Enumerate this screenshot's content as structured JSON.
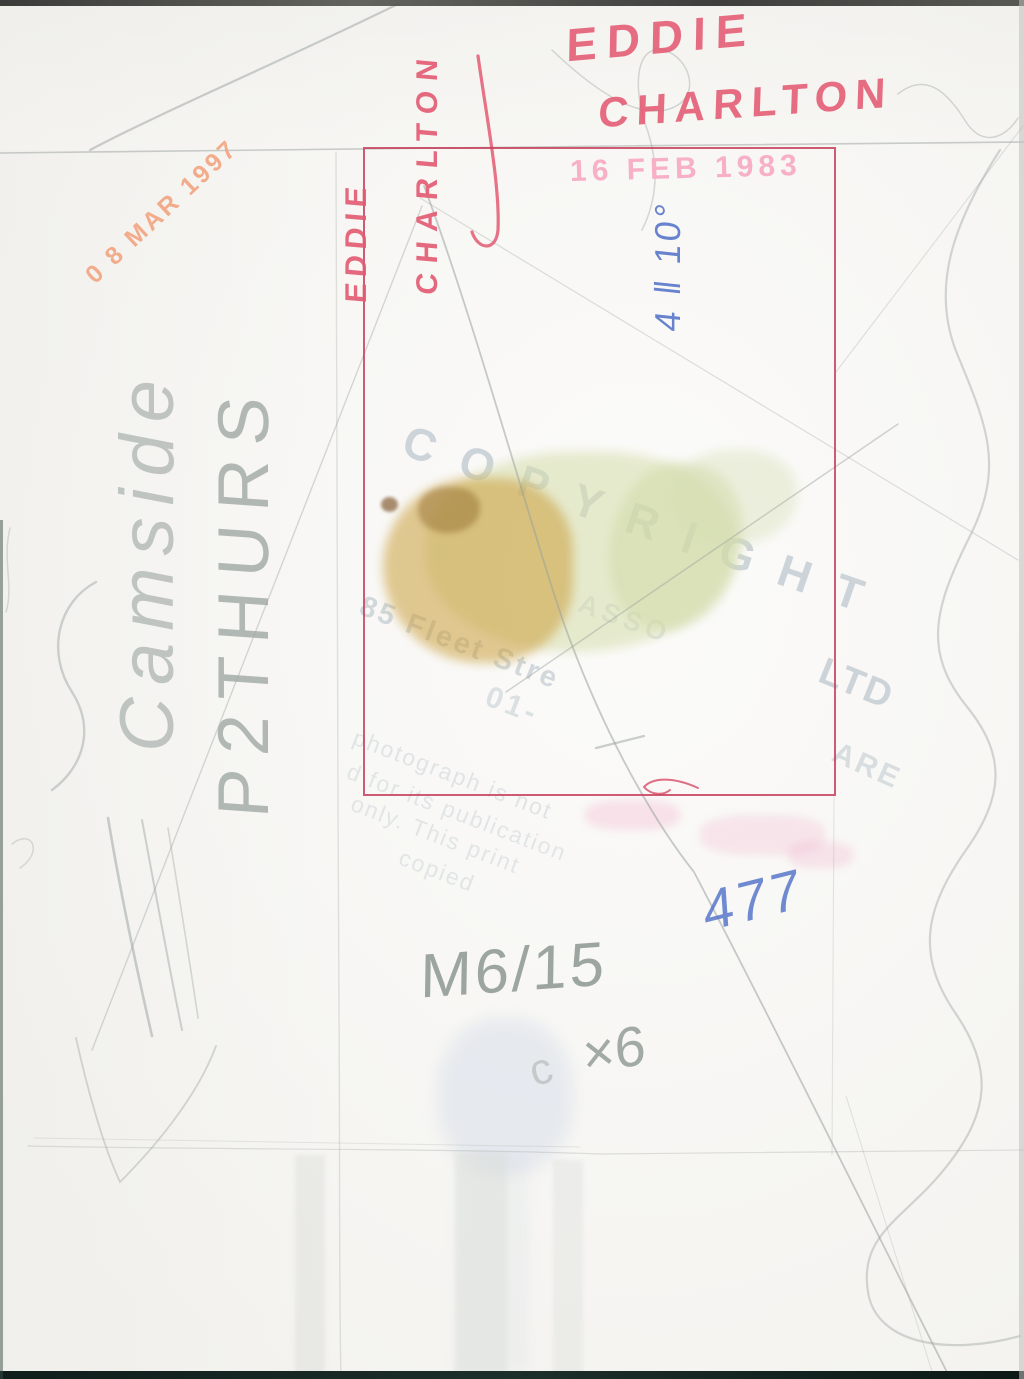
{
  "scan": {
    "description": "Back of a press photograph with handwritten captions, stamps and crop marks",
    "handwriting_red": {
      "line1": "EDDIE",
      "line2": "CHARLTON",
      "vertical_line1": "EDDIE",
      "vertical_line2": "CHARLTON"
    },
    "handwriting_blue": {
      "sideways_note": "4 ‖ 10°",
      "number": "477"
    },
    "handwriting_pencil": {
      "reference": "M6/15",
      "multiplier": "×6",
      "multiplier_prefix": "c",
      "cursive_word": "Camside",
      "vertical_code": "P2THURS"
    },
    "stamps": {
      "date_pink": "16 FEB 1983",
      "date_orange": "0 8 MAR 1997",
      "copyright": "COPYRIGHT",
      "fragment_asso": "ASSO",
      "fragment_ltd": "LTD",
      "fragment_are": "ARE",
      "fragment_address": "85 Fleet Stre",
      "fragment_phone": "01-",
      "fragment_line_not": "photograph is not",
      "fragment_line_publication": "d for its publication",
      "fragment_line_only": "only. This print",
      "fragment_line_copied": "copied"
    },
    "colors": {
      "red_pen": "#e45a72",
      "red_box": "#c5405c",
      "blue_ink": "#4f6fc8",
      "pink_stamp": "#f7b0c7",
      "orange_stamp": "#f3a581",
      "pencil": "#98a19c",
      "ghost_stamp": "#c6ced4",
      "paper": "#f8f7f4"
    }
  }
}
